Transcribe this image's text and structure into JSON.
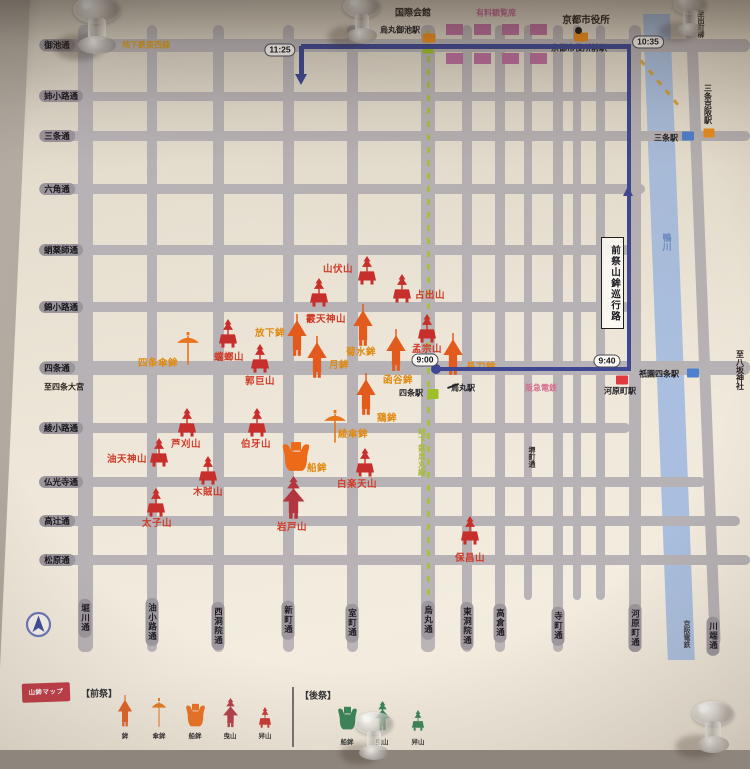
{
  "map": {
    "street_color": "#b7b2b5",
    "streets_h": [
      {
        "name": "御池通",
        "y": 45,
        "h": 13,
        "x1": 40,
        "x2": 750,
        "lx": 57
      },
      {
        "name": "姉小路通",
        "y": 96,
        "h": 9,
        "x1": 40,
        "x2": 640,
        "lx": 61
      },
      {
        "name": "三条通",
        "y": 136,
        "h": 10,
        "x1": 40,
        "x2": 750,
        "lx": 57
      },
      {
        "name": "六角通",
        "y": 189,
        "h": 10,
        "x1": 40,
        "x2": 645,
        "lx": 57
      },
      {
        "name": "蛸薬師通",
        "y": 250,
        "h": 10,
        "x1": 40,
        "x2": 630,
        "lx": 61
      },
      {
        "name": "錦小路通",
        "y": 307,
        "h": 10,
        "x1": 40,
        "x2": 630,
        "lx": 61
      },
      {
        "name": "四条通",
        "y": 368,
        "h": 14,
        "x1": 40,
        "x2": 750,
        "lx": 57
      },
      {
        "name": "綾小路通",
        "y": 428,
        "h": 10,
        "x1": 40,
        "x2": 630,
        "lx": 61
      },
      {
        "name": "仏光寺通",
        "y": 482,
        "h": 10,
        "x1": 40,
        "x2": 705,
        "lx": 61
      },
      {
        "name": "高辻通",
        "y": 521,
        "h": 10,
        "x1": 40,
        "x2": 740,
        "lx": 57
      },
      {
        "name": "松原通",
        "y": 560,
        "h": 10,
        "x1": 40,
        "x2": 750,
        "lx": 57
      }
    ],
    "streets_v": [
      {
        "name": "堀川通",
        "x": 85,
        "w": 15,
        "y1": 25,
        "y2": 652,
        "ly": 618
      },
      {
        "name": "油小路通",
        "x": 152,
        "w": 10,
        "y1": 25,
        "y2": 652,
        "ly": 622
      },
      {
        "name": "西洞院通",
        "x": 218,
        "w": 11,
        "y1": 25,
        "y2": 652,
        "ly": 626
      },
      {
        "name": "新町通",
        "x": 288,
        "w": 11,
        "y1": 25,
        "y2": 652,
        "ly": 620
      },
      {
        "name": "室町通",
        "x": 352,
        "w": 11,
        "y1": 25,
        "y2": 652,
        "ly": 623
      },
      {
        "name": "烏丸通",
        "x": 428,
        "w": 14,
        "y1": 25,
        "y2": 652,
        "ly": 620
      },
      {
        "name": "東洞院通",
        "x": 467,
        "w": 10,
        "y1": 25,
        "y2": 652,
        "ly": 626
      },
      {
        "name": "高倉通",
        "x": 500,
        "w": 10,
        "y1": 25,
        "y2": 652,
        "ly": 623
      },
      {
        "name": "堺町通",
        "x": 528,
        "w": 8,
        "y1": 25,
        "y2": 600,
        "ly": 457,
        "mid": true
      },
      {
        "name": "寺町通",
        "x": 558,
        "w": 10,
        "y1": 25,
        "y2": 652,
        "ly": 626
      },
      {
        "name": "河原町通",
        "x": 635,
        "w": 12,
        "y1": 25,
        "y2": 652,
        "ly": 628
      },
      {
        "name": "川端通",
        "x": 690,
        "w": 11,
        "y1": 0,
        "y2": 645,
        "ly": 636,
        "skew": 2.2,
        "label_x": 713
      }
    ],
    "streets_v_unlabeled": [
      {
        "x": 577,
        "w": 8,
        "y1": 25,
        "y2": 600
      },
      {
        "x": 600,
        "w": 9,
        "y1": 25,
        "y2": 600
      }
    ],
    "river": {
      "x": 643,
      "w": 27,
      "y1": 14,
      "y2": 660,
      "skew": 2.2,
      "color": "#aabfdf",
      "label": "鴨川",
      "rail_label": "京阪電鉄"
    },
    "subway_karasuma": {
      "x": 428,
      "y1": 30,
      "y2": 598,
      "color": "#a8bf3f"
    },
    "subway_tozai": {
      "x": 660,
      "y": 84,
      "len": 62,
      "color": "#d9a02a"
    },
    "stands": {
      "color": "#bd6f9e",
      "w": 17,
      "h": 11,
      "rows": [
        {
          "y": 24,
          "xs": [
            446,
            474,
            502,
            530
          ]
        },
        {
          "y": 53,
          "xs": [
            446,
            474,
            502,
            530
          ]
        }
      ]
    },
    "route": {
      "color": "#3d4792",
      "label": "前祭山鉾巡行路",
      "times": [
        {
          "t": "11:25",
          "x": 280,
          "y": 50
        },
        {
          "t": "10:35",
          "x": 648,
          "y": 42
        },
        {
          "t": "9:40",
          "x": 607,
          "y": 361
        },
        {
          "t": "9:00",
          "x": 425,
          "y": 360
        }
      ]
    },
    "stations": [
      {
        "name": "烏丸御池駅",
        "x": 400,
        "y": 30,
        "markers": [
          {
            "c": "#ef8f1d",
            "x": 429,
            "y": 38,
            "w": 13,
            "h": 9
          },
          {
            "c": "#9ebf2a",
            "x": 428,
            "y": 49,
            "w": 11,
            "h": 9
          }
        ]
      },
      {
        "name": "京都市役所前駅",
        "x": 579,
        "y": 48,
        "markers": [
          {
            "c": "#ef8f1d",
            "x": 581,
            "y": 37,
            "w": 14,
            "h": 9
          }
        ]
      },
      {
        "name": "三条駅",
        "x": 666,
        "y": 138,
        "markers": [
          {
            "c": "#4d7fd0",
            "x": 688,
            "y": 136,
            "w": 12,
            "h": 9
          }
        ]
      },
      {
        "name": "三条京阪駅",
        "x": 708,
        "y": 104,
        "v": true,
        "markers": [
          {
            "c": "#ef8f1d",
            "x": 709,
            "y": 133,
            "w": 11,
            "h": 9
          }
        ]
      },
      {
        "name": "祇園四条駅",
        "x": 659,
        "y": 374,
        "markers": [
          {
            "c": "#4d7fd0",
            "x": 693,
            "y": 373,
            "w": 12,
            "h": 9
          }
        ]
      },
      {
        "name": "河原町駅",
        "x": 620,
        "y": 391,
        "markers": [
          {
            "c": "#e23940",
            "x": 622,
            "y": 380,
            "w": 12,
            "h": 9
          }
        ]
      },
      {
        "name": "四条駅",
        "x": 411,
        "y": 393,
        "markers": [
          {
            "c": "#9ebf2a",
            "x": 433,
            "y": 394,
            "w": 11,
            "h": 10
          }
        ]
      },
      {
        "name": "烏丸駅",
        "x": 463,
        "y": 388,
        "markers": []
      }
    ],
    "landmarks": [
      {
        "text": "国際会館",
        "x": 413,
        "y": 12,
        "c": "#2a2420",
        "fs": 9
      },
      {
        "text": "京都市役所",
        "x": 586,
        "y": 19,
        "c": "#2a2420",
        "fs": 9.5
      },
      {
        "text": "有料観覧席",
        "x": 496,
        "y": 13,
        "c": "#c76a96",
        "fs": 8
      },
      {
        "text": "地下鉄東西線",
        "x": 146,
        "y": 45,
        "c": "#d79a1e",
        "fs": 8
      },
      {
        "text": "地下鉄烏丸線",
        "x": 422,
        "y": 452,
        "c": "#a5bc3a",
        "fs": 8,
        "v": true
      },
      {
        "text": "阪急電鉄",
        "x": 541,
        "y": 388,
        "c": "#d46e8e",
        "fs": 8
      },
      {
        "text": "至八坂神社",
        "x": 740,
        "y": 370,
        "c": "#2a2420",
        "fs": 8,
        "v": true
      },
      {
        "text": "至出町柳",
        "x": 700,
        "y": 24,
        "c": "#2a2420",
        "fs": 7,
        "v": true
      },
      {
        "text": "至四条大宮",
        "x": 64,
        "y": 387,
        "c": "#2a2420",
        "fs": 8
      }
    ],
    "decor": [
      {
        "type": "dot",
        "x": 578,
        "y": 30,
        "d": 7,
        "c": "#1c1a18"
      },
      {
        "type": "line",
        "x": 447,
        "y": 385,
        "w": 12,
        "h": 1.5,
        "c": "#2a2a30",
        "rot": -20
      }
    ],
    "float_colors": {
      "hoko": "#e35a1d",
      "kasaboko": "#e8751c",
      "funeboko": "#ed6b18",
      "hikiyama": "#b23540",
      "kakiyama": "#c62f2b",
      "label_red": "#d03a28",
      "label_orange": "#e08a12"
    },
    "icon_dims": {
      "hoko": {
        "w": 22,
        "h": 44
      },
      "kasaboko": {
        "w": 24,
        "h": 34
      },
      "funeboko": {
        "w": 30,
        "h": 32
      },
      "hikiyama": {
        "w": 25,
        "h": 44
      },
      "kakiyama": {
        "w": 24,
        "h": 29
      }
    },
    "floats": [
      {
        "n": "山伏山",
        "t": "kakiyama",
        "x": 367,
        "y": 285,
        "lx": 338,
        "ly": 268,
        "lc": "red"
      },
      {
        "n": "占出山",
        "t": "kakiyama",
        "x": 402,
        "y": 303,
        "lx": 430,
        "ly": 294,
        "lc": "red"
      },
      {
        "n": "霰天神山",
        "t": "kakiyama",
        "x": 319,
        "y": 307,
        "lx": 326,
        "ly": 318,
        "lc": "red"
      },
      {
        "n": "孟宗山",
        "t": "kakiyama",
        "x": 427,
        "y": 343,
        "lx": 427,
        "ly": 348,
        "lc": "red"
      },
      {
        "n": "放下鉾",
        "t": "hoko",
        "x": 297,
        "y": 358,
        "lx": 270,
        "ly": 332,
        "lc": "org"
      },
      {
        "n": "菊水鉾",
        "t": "hoko",
        "x": 363,
        "y": 348,
        "lx": 361,
        "ly": 351,
        "lc": "org"
      },
      {
        "n": "月鉾",
        "t": "hoko",
        "x": 317,
        "y": 380,
        "lx": 339,
        "ly": 364,
        "lc": "org"
      },
      {
        "n": "函谷鉾",
        "t": "hoko",
        "x": 396,
        "y": 373,
        "lx": 398,
        "ly": 379,
        "lc": "org"
      },
      {
        "n": "長刀鉾",
        "t": "hoko",
        "x": 453,
        "y": 377,
        "lx": 481,
        "ly": 366,
        "lc": "org"
      },
      {
        "n": "鶏鉾",
        "t": "hoko",
        "x": 366,
        "y": 417,
        "lx": 387,
        "ly": 417,
        "lc": "org"
      },
      {
        "n": "郭巨山",
        "t": "kakiyama",
        "x": 260,
        "y": 373,
        "lx": 260,
        "ly": 380,
        "lc": "red"
      },
      {
        "n": "蟷螂山",
        "t": "kakiyama",
        "x": 228,
        "y": 348,
        "lx": 229,
        "ly": 356,
        "lc": "red"
      },
      {
        "n": "四条傘鉾",
        "t": "kasaboko",
        "x": 188,
        "y": 366,
        "lx": 158,
        "ly": 362,
        "lc": "org"
      },
      {
        "n": "芦刈山",
        "t": "kakiyama",
        "x": 187,
        "y": 437,
        "lx": 186,
        "ly": 443,
        "lc": "red"
      },
      {
        "n": "油天神山",
        "t": "kakiyama",
        "x": 159,
        "y": 467,
        "lx": 127,
        "ly": 458,
        "lc": "red"
      },
      {
        "n": "伯牙山",
        "t": "kakiyama",
        "x": 257,
        "y": 437,
        "lx": 256,
        "ly": 443,
        "lc": "red"
      },
      {
        "n": "木賊山",
        "t": "kakiyama",
        "x": 208,
        "y": 485,
        "lx": 208,
        "ly": 491,
        "lc": "red"
      },
      {
        "n": "太子山",
        "t": "kakiyama",
        "x": 156,
        "y": 517,
        "lx": 157,
        "ly": 522,
        "lc": "red"
      },
      {
        "n": "綾傘鉾",
        "t": "kasaboko",
        "x": 335,
        "y": 444,
        "lx": 353,
        "ly": 433,
        "lc": "org"
      },
      {
        "n": "船鉾",
        "t": "funeboko",
        "x": 296,
        "y": 473,
        "lx": 317,
        "ly": 467,
        "lc": "org"
      },
      {
        "n": "白楽天山",
        "t": "kakiyama",
        "x": 365,
        "y": 477,
        "lx": 357,
        "ly": 483,
        "lc": "red"
      },
      {
        "n": "岩戸山",
        "t": "hikiyama",
        "x": 293,
        "y": 520,
        "lx": 292,
        "ly": 526,
        "lc": "red"
      },
      {
        "n": "保昌山",
        "t": "kakiyama",
        "x": 470,
        "y": 545,
        "lx": 470,
        "ly": 557,
        "lc": "red"
      }
    ]
  },
  "legend": {
    "title": "山鉾マップ",
    "saki_header": "【前祭】",
    "ato_header": "【後祭】",
    "saki_items": [
      {
        "label": "鉾",
        "t": "hoko",
        "c": "#e35a1d",
        "x": 125
      },
      {
        "label": "傘鉾",
        "t": "kasaboko",
        "c": "#e8751c",
        "x": 159
      },
      {
        "label": "船鉾",
        "t": "funeboko",
        "c": "#ed6b18",
        "x": 195
      },
      {
        "label": "曳山",
        "t": "hikiyama",
        "c": "#b23540",
        "x": 230
      },
      {
        "label": "舁山",
        "t": "kakiyama",
        "c": "#c62f2b",
        "x": 265
      }
    ],
    "ato_items": [
      {
        "label": "船鉾",
        "t": "funeboko",
        "c": "#2f7d4f",
        "x": 347
      },
      {
        "label": "曳山",
        "t": "hikiyama",
        "c": "#2f7d4f",
        "x": 382
      },
      {
        "label": "舁山",
        "t": "kakiyama",
        "c": "#2f7d4f",
        "x": 418
      }
    ],
    "saki_icon_bottom": 728,
    "saki_label_y": 735,
    "ato_icon_bottom": 731,
    "ato_label_y": 741
  },
  "pins": [
    {
      "x": 97,
      "y": 26,
      "s": 1.25
    },
    {
      "x": 362,
      "y": 20,
      "s": 1.0
    },
    {
      "x": 690,
      "y": 16,
      "s": 0.9
    },
    {
      "x": 374,
      "y": 737,
      "s": 1.0
    },
    {
      "x": 713,
      "y": 728,
      "s": 1.1
    }
  ]
}
